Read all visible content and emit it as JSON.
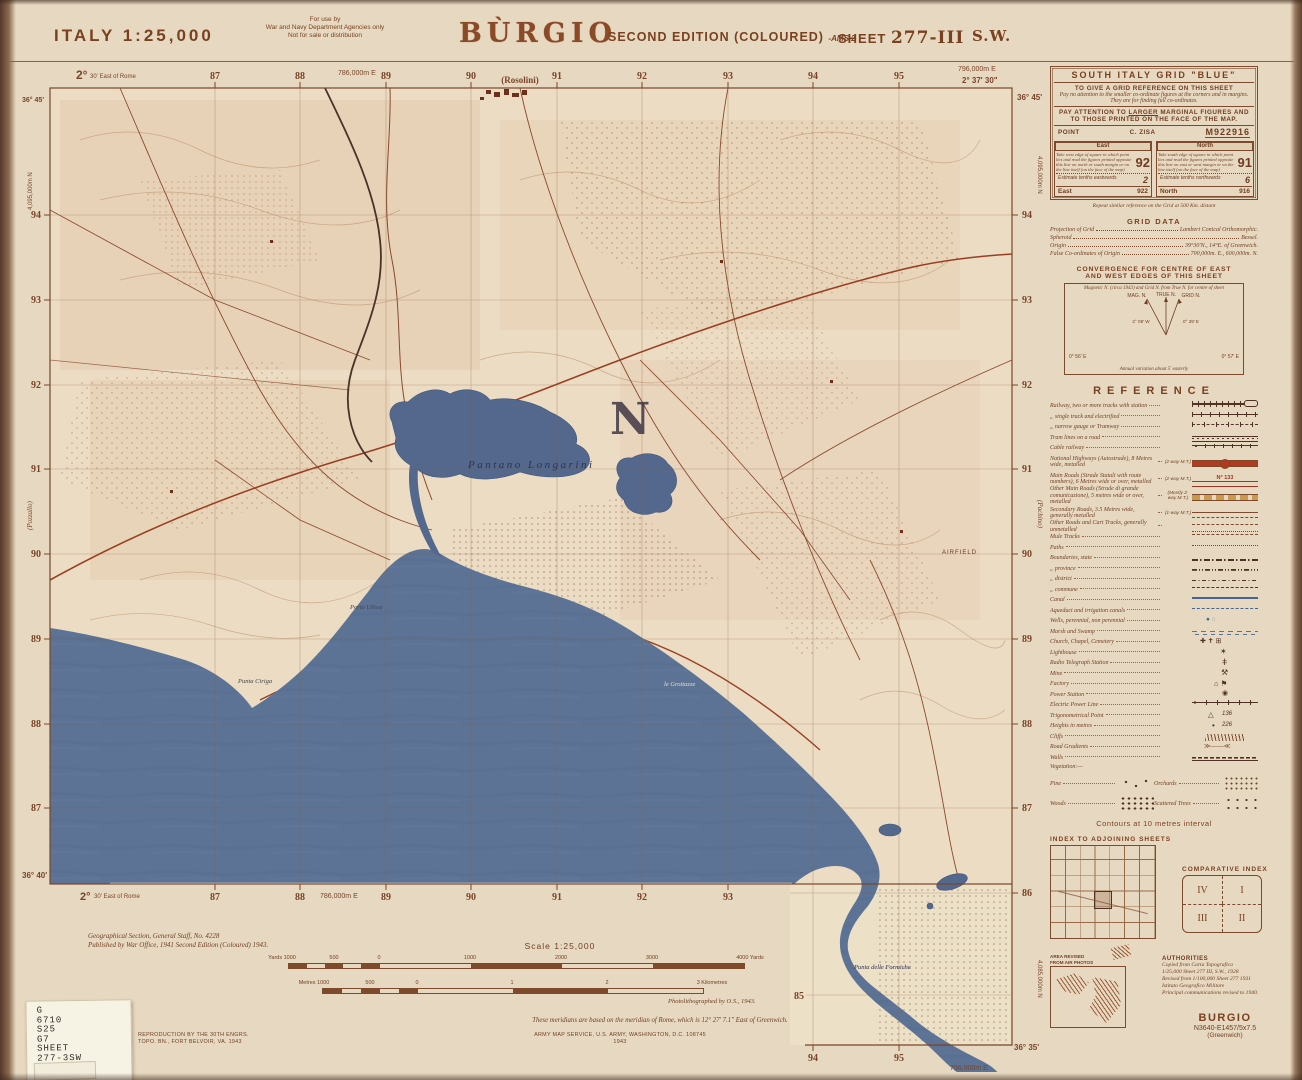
{
  "colors": {
    "ink": "#7d4a2c",
    "sea": "#5c7395",
    "paper": "#e9dcc4",
    "road_red": "#a03522"
  },
  "header": {
    "country_scale": "ITALY  1:25,000",
    "use1": "For use by",
    "use2": "War and Navy Department Agencies only",
    "use3": "Not for sale or distribution",
    "title": "BÙRGIO",
    "edition": "SECOND EDITION (COLOURED)",
    "ams": "-AMS 2",
    "sheet_label": "SHEET",
    "sheet_no": "277-III",
    "quad": "S.W."
  },
  "grid_panel": {
    "title": "SOUTH ITALY GRID \"BLUE\"",
    "l1": "TO GIVE A GRID REFERENCE ON THIS SHEET",
    "l2": "Pay no attention to the smaller co-ordinate figures at the corners and in margins.",
    "l3": "They are for finding full co-ordinates.",
    "att1": "PAY ATTENTION TO",
    "att_larger": "LARGER",
    "att2": "MARGINAL FIGURES AND TO",
    "att3": "THOSE PRINTED ON THE FACE OF THE MAP.",
    "point_label": "POINT",
    "point_name": "C. ZISA",
    "point_ref": "M922916",
    "east": {
      "head": "East",
      "text": "Take west edge of square in which point lies and read the figures printed opposite this line on north or south margin or on the line itself (on the face of the map)",
      "big": "92",
      "estimate": "Estimate tenths eastwards",
      "tenth": "2",
      "foot_label": "East",
      "foot_value": "922"
    },
    "north": {
      "head": "North",
      "text": "Take south edge of square in which point lies and read the figures printed opposite this line on east or west margin or on the line itself (on the face of the map)",
      "big": "91",
      "estimate": "Estimate tenths northwards",
      "tenth": "6",
      "foot_label": "North",
      "foot_value": "916"
    },
    "repeat_note": "Repeat similar reference on the Grid at 500 Km. distant"
  },
  "grid_data": {
    "title": "GRID DATA",
    "rows": [
      {
        "label": "Projection of Grid",
        "value": "Lambert Conical Orthomorphic."
      },
      {
        "label": "Spheroid",
        "value": "Bessel."
      },
      {
        "label": "Origin",
        "value": "39°30'N., 14°E. of Greenwich."
      },
      {
        "label": "False Co-ordinates of Origin",
        "value": "700,000m. E., 600,000m. N."
      }
    ]
  },
  "convergence": {
    "title1": "CONVERGENCE FOR CENTRE OF EAST",
    "title2": "AND WEST EDGES OF THIS SHEET",
    "note": "Magnetic N. (circa 1943) and Grid N. from True N. for centre of sheet",
    "true_n": "TRUE N.",
    "mag_n": "MAG. N.",
    "grid_n": "GRID N.",
    "angle_left": "2° 08' W",
    "angle_right": "0° 39' E",
    "corner_left": "0° 56' E",
    "corner_right": "0° 57' E",
    "variation": "Annual variation about 5' easterly"
  },
  "reference": {
    "title": "REFERENCE",
    "route_number": "N° 133",
    "trig_value": "136",
    "height_value": "226",
    "rows": [
      {
        "label": "Railway, two or more tracks with station",
        "note": ""
      },
      {
        "label": "„  single track and electrified",
        "note": ""
      },
      {
        "label": "„  narrow gauge or Tramway",
        "note": ""
      },
      {
        "label": "Tram lines on a road",
        "note": ""
      },
      {
        "label": "Cable railway",
        "note": ""
      },
      {
        "label": "National Highways (Autostrade), 8 Metres wide, metalled",
        "note": "(2-way M.T.)"
      },
      {
        "label": "Main Roads (Strade Statali with route numbers), 6 Metres wide or over, metalled",
        "note": "(2-way M.T.)"
      },
      {
        "label": "Other Main Roads (Strade di grande comunicazione), 5 metres wide or over, metalled",
        "note": "(Mostly 2-way M.T.)"
      },
      {
        "label": "Secondary Roads, 3.5 Metres wide, generally metalled",
        "note": "(1-way M.T.)"
      },
      {
        "label": "Other Roads and Cart Tracks, generally unmetalled",
        "note": ""
      },
      {
        "label": "Mule Tracks",
        "note": ""
      },
      {
        "label": "Paths",
        "note": ""
      },
      {
        "label": "Boundaries, state",
        "note": ""
      },
      {
        "label": "„  province",
        "note": ""
      },
      {
        "label": "„  district",
        "note": ""
      },
      {
        "label": "„  commune",
        "note": ""
      },
      {
        "label": "Canal",
        "note": ""
      },
      {
        "label": "Aqueduct and irrigation canals",
        "note": ""
      },
      {
        "label": "Wells, perennial, non perennial",
        "note": ""
      },
      {
        "label": "Marsh and Swamp",
        "note": ""
      },
      {
        "label": "Church, Chapel, Cemetery",
        "note": ""
      },
      {
        "label": "Lighthouse",
        "note": ""
      },
      {
        "label": "Radio Telegraph Station",
        "note": ""
      },
      {
        "label": "Mine",
        "note": ""
      },
      {
        "label": "Factory",
        "note": ""
      },
      {
        "label": "Power Station",
        "note": ""
      },
      {
        "label": "Electric Power Line",
        "note": ""
      },
      {
        "label": "Trigonometrical Point",
        "note": ""
      },
      {
        "label": "Heights in metres",
        "note": ""
      },
      {
        "label": "Cliffs",
        "note": ""
      },
      {
        "label": "Road Gradients",
        "note": ""
      },
      {
        "label": "Walls",
        "note": ""
      }
    ],
    "vegetation_label": "Vegetation:—",
    "veg": {
      "pine": "Pine",
      "orchards": "Orchards",
      "woods": "Woods",
      "scattered": "Scattered Trees"
    },
    "contours_note": "Contours at 10 metres interval"
  },
  "indexes": {
    "adjoining_title": "INDEX TO ADJOINING SHEETS",
    "comparative_title": "COMPARATIVE INDEX",
    "q1": "IV",
    "q2": "I",
    "q3": "III",
    "q4": "II"
  },
  "air_photo": {
    "l1": "AREA REVISED",
    "l2": "FROM AIR PHOTOS"
  },
  "authorities": {
    "title": "AUTHORITIES",
    "lines": [
      "Copied from Carta Topografica",
      "1/25,000 Sheet 277 III, S.W., 1928",
      "Revised from 1/100,000 Sheet 277 1931",
      "Istituto Geografico Militare",
      "Principal communications revised to 1940."
    ]
  },
  "sheet_id": {
    "name": "BURGIO",
    "code": "N3640-E1457/5x7.5",
    "datum": "(Greenwich)"
  },
  "map": {
    "grid_top": [
      "87",
      "88",
      "89",
      "90",
      "91",
      "92",
      "93",
      "94",
      "95"
    ],
    "grid_left": [
      "94",
      "93",
      "92",
      "91",
      "90",
      "89",
      "88",
      "87"
    ],
    "grid_right": [
      "94",
      "93",
      "92",
      "91",
      "90",
      "89",
      "88",
      "87",
      "86"
    ],
    "grid_bottom": [
      "87",
      "88",
      "89",
      "90",
      "91",
      "92",
      "93"
    ],
    "ext_bottom": [
      "94",
      "95"
    ],
    "margins": {
      "deg_tl": "2°",
      "min_tl": "30' East of Rome",
      "easting_tl": "786,000m E",
      "rosolini": "(Rosolini)",
      "easting_tr": "796,000m E",
      "deg_tr": "2° 37' 30\"",
      "lat_tr": "36° 45'",
      "lat_tl": "36° 45'",
      "northing_left": "4,095,000m N",
      "pozzallo": "(Pozzallo)",
      "northing_right": "4,095,000m N",
      "pachino": "(Pachino)",
      "lat_bl": "36° 40'",
      "deg_bl": "2°",
      "min_bl": "30' East of Rome",
      "easting_bl": "786,000m E",
      "ext_85": "85",
      "ext_easting": "796,000m E",
      "ext_lat": "36° 35'",
      "ext_northing": "4,085,000m N"
    },
    "labels": {
      "pantano": "Pantano Longarini",
      "district_n": "N",
      "porto_ulisse": "Porto Ulisse",
      "punta_ciriga": "Punta Ciriga",
      "grottazze": "le Grottazze",
      "formiche": "Punta delle Formiche",
      "airfield": "AIRFIELD"
    }
  },
  "scale_block": {
    "title": "Scale 1:25,000",
    "yards": [
      "Yards 1000",
      "500",
      "0",
      "1000",
      "2000",
      "3000",
      "4000 Yards"
    ],
    "metres": [
      "Metres 1000",
      "500",
      "0",
      "1",
      "2",
      "3 Kilometres"
    ]
  },
  "footnotes": {
    "gsgs1": "Geographical Section, General Staff, No. 4228",
    "gsgs2": "Published by War Office, 1941 Second Edition (Coloured) 1943.",
    "photolitho": "Photolithographed by O.S., 1943.",
    "meridian": "These meridians are based on the meridian of Rome, which is 12° 27' 7.1\" East of Greenwich.",
    "repro1": "REPRODUCTION BY THE 30TH ENGRS.",
    "repro2": "TOPO. BN., FORT BELVOIR, VA. 1943",
    "ams1": "ARMY MAP SERVICE, U.S. ARMY, WASHINGTON, D.C. 108745",
    "ams2": "1943"
  },
  "library_label": {
    "lines": [
      "G",
      "6710",
      "S25",
      "G7",
      "SHEET",
      "277-3SW",
      "PCL MAP"
    ]
  }
}
